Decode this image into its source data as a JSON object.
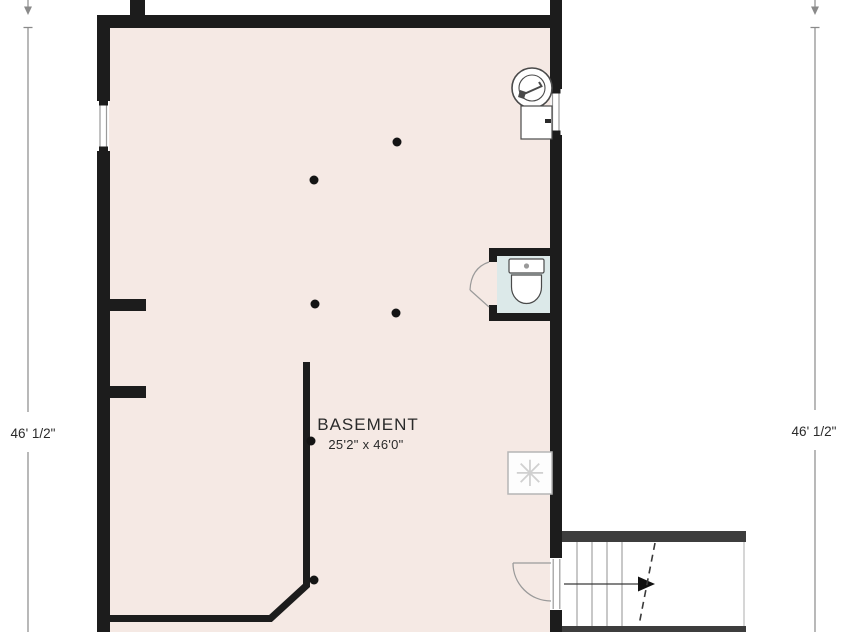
{
  "room": {
    "label": "BASEMENT",
    "size": "25'2\" x 46'0\""
  },
  "dimensions": {
    "left": "46' 1/2\"",
    "right": "46' 1/2\""
  },
  "icons": {
    "ac_unit_glyph": "✳"
  },
  "colors": {
    "floor": "#f5e9e4",
    "wall": "#1c1c1c",
    "stair_wall": "#3d3d3d",
    "wc_floor": "#dce9e9",
    "fixture_stroke": "#4a4a4a",
    "dim_line": "#8a8a8a",
    "thin_line": "#9a9a9a",
    "text_color": "#2a2a2a",
    "ac_glyph": "#d0d0d0"
  }
}
